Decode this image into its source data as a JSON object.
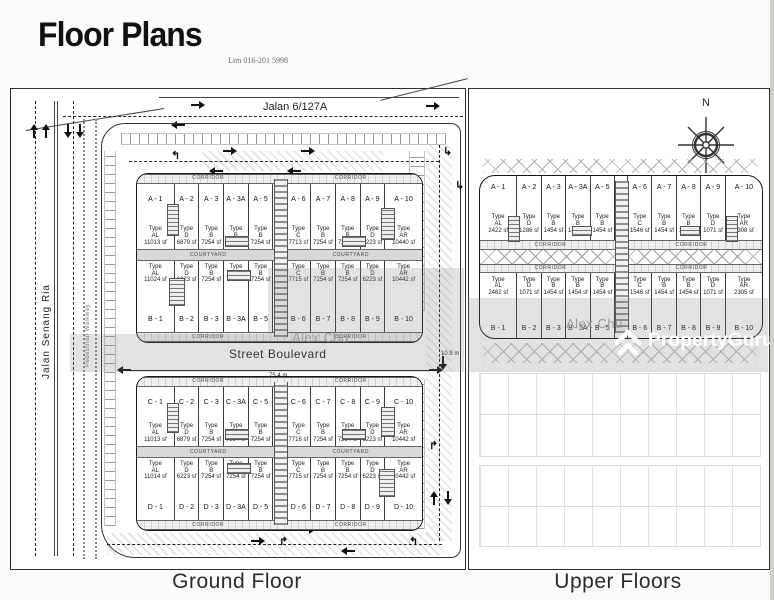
{
  "title": "Floor Plans",
  "contact_note": "Lim 016-201 5998",
  "captions": {
    "ground": "Ground Floor",
    "upper": "Upper Floors"
  },
  "roads": {
    "top": "Jalan 6/127A",
    "left": "Jalan Senang Ria",
    "walkway": "Pedestrian Walkway",
    "boulevard": "Street Boulevard"
  },
  "dimensions": {
    "boulevard_length": "75.4 m",
    "boulevard_depth": "10.9 m"
  },
  "labels": {
    "courtyard": "COURTYARD",
    "corridor": "CORRIDOR",
    "type_word": "Type",
    "north": "N"
  },
  "watermark": {
    "brand": "PropertyGuru",
    "agent": "Alex Chu",
    "color": "#ffffff"
  },
  "ground_floor": {
    "rows": {
      "A": [
        {
          "id": "A - 1",
          "type": "AL",
          "area": "11013 sf"
        },
        {
          "id": "A - 2",
          "type": "D",
          "area": "6879 sf"
        },
        {
          "id": "A - 3",
          "type": "B",
          "area": "7254 sf"
        },
        {
          "id": "A - 3A",
          "type": "B",
          "area": "7254 sf"
        },
        {
          "id": "A - 5",
          "type": "B",
          "area": "7254 sf"
        },
        {
          "id": "A - 6",
          "type": "C",
          "area": "7713 sf"
        },
        {
          "id": "A - 7",
          "type": "B",
          "area": "7254 sf"
        },
        {
          "id": "A - 8",
          "type": "B",
          "area": "7254 sf"
        },
        {
          "id": "A - 9",
          "type": "D",
          "area": "6223 sf"
        },
        {
          "id": "A - 10",
          "type": "AR",
          "area": "10440 sf"
        }
      ],
      "B": [
        {
          "id": "B - 1",
          "type": "AL",
          "area": "11024 sf"
        },
        {
          "id": "B - 2",
          "type": "D",
          "area": "6223 sf"
        },
        {
          "id": "B - 3",
          "type": "B",
          "area": "7254 sf"
        },
        {
          "id": "B - 3A",
          "type": "B",
          "area": "7254 sf"
        },
        {
          "id": "B - 5",
          "type": "B",
          "area": "7254 sf"
        },
        {
          "id": "B - 6",
          "type": "C",
          "area": "7715 sf"
        },
        {
          "id": "B - 7",
          "type": "B",
          "area": "7254 sf"
        },
        {
          "id": "B - 8",
          "type": "B",
          "area": "7254 sf"
        },
        {
          "id": "B - 9",
          "type": "D",
          "area": "6223 sf"
        },
        {
          "id": "B - 10",
          "type": "AR",
          "area": "10442 sf"
        }
      ],
      "C": [
        {
          "id": "C - 1",
          "type": "AL",
          "area": "11013 sf"
        },
        {
          "id": "C - 2",
          "type": "D",
          "area": "6879 sf"
        },
        {
          "id": "C - 3",
          "type": "B",
          "area": "7254 sf"
        },
        {
          "id": "C - 3A",
          "type": "B",
          "area": "7254 sf"
        },
        {
          "id": "C - 5",
          "type": "B",
          "area": "7254 sf"
        },
        {
          "id": "C - 6",
          "type": "C",
          "area": "7716 sf"
        },
        {
          "id": "C - 7",
          "type": "B",
          "area": "7254 sf"
        },
        {
          "id": "C - 8",
          "type": "B",
          "area": "7254 sf"
        },
        {
          "id": "C - 9",
          "type": "D",
          "area": "6223 sf"
        },
        {
          "id": "C - 10",
          "type": "AR",
          "area": "10442 sf"
        }
      ],
      "D": [
        {
          "id": "D - 1",
          "type": "AL",
          "area": "11014 sf"
        },
        {
          "id": "D - 2",
          "type": "D",
          "area": "6223 sf"
        },
        {
          "id": "D - 3",
          "type": "B",
          "area": "7254 sf"
        },
        {
          "id": "D - 3A",
          "type": "B",
          "area": "7254 sf"
        },
        {
          "id": "D - 5",
          "type": "B",
          "area": "7254 sf"
        },
        {
          "id": "D - 6",
          "type": "C",
          "area": "7715 sf"
        },
        {
          "id": "D - 7",
          "type": "B",
          "area": "7254 sf"
        },
        {
          "id": "D - 8",
          "type": "B",
          "area": "7254 sf"
        },
        {
          "id": "D - 9",
          "type": "D",
          "area": "6223 sf"
        },
        {
          "id": "D - 10",
          "type": "AR",
          "area": "10442 sf"
        }
      ]
    }
  },
  "upper_floors": {
    "rows": {
      "A": [
        {
          "id": "A - 1",
          "type": "AL",
          "area": "2422 sf"
        },
        {
          "id": "A - 2",
          "type": "D",
          "area": "1286 sf"
        },
        {
          "id": "A - 3",
          "type": "B",
          "area": "1454 sf"
        },
        {
          "id": "A - 3A",
          "type": "B",
          "area": "1454 sf"
        },
        {
          "id": "A - 5",
          "type": "B",
          "area": "1454 sf"
        },
        {
          "id": "A - 6",
          "type": "C",
          "area": "1546 sf"
        },
        {
          "id": "A - 7",
          "type": "B",
          "area": "1454 sf"
        },
        {
          "id": "A - 8",
          "type": "B",
          "area": "1454 sf"
        },
        {
          "id": "A - 9",
          "type": "D",
          "area": "1071 sf"
        },
        {
          "id": "A - 10",
          "type": "AR",
          "area": "2308 sf"
        }
      ],
      "B": [
        {
          "id": "B - 1",
          "type": "AL",
          "area": "2462 sf"
        },
        {
          "id": "B - 2",
          "type": "D",
          "area": "1071 sf"
        },
        {
          "id": "B - 3",
          "type": "B",
          "area": "1454 sf"
        },
        {
          "id": "B - 3A",
          "type": "B",
          "area": "1454 sf"
        },
        {
          "id": "B - 5",
          "type": "B",
          "area": "1454 sf"
        },
        {
          "id": "B - 6",
          "type": "C",
          "area": "1546 sf"
        },
        {
          "id": "B - 7",
          "type": "B",
          "area": "1454 sf"
        },
        {
          "id": "B - 8",
          "type": "B",
          "area": "1454 sf"
        },
        {
          "id": "B - 9",
          "type": "D",
          "area": "1071 sf"
        },
        {
          "id": "B - 10",
          "type": "AR",
          "area": "2305 sf"
        }
      ]
    }
  }
}
